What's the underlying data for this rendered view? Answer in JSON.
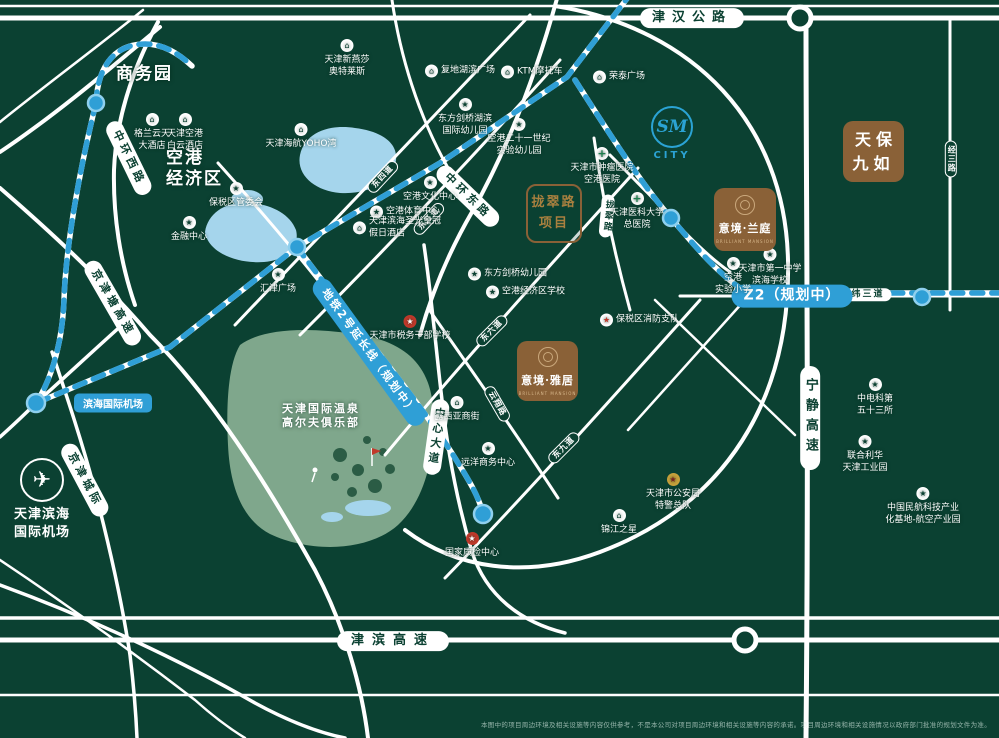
{
  "colors": {
    "background": "#0b4132",
    "road": "#ffffff",
    "metro_blue": "#2f9fd6",
    "lake": "#a5d5ec",
    "golf": "#7fa78c",
    "project_brown": "#8a6137"
  },
  "icon_glyphs": {
    "building": "⌂",
    "star": "★",
    "school": "★",
    "cross": "+",
    "red-star": "★",
    "police": "★",
    "fire": "★",
    "plane": "✈"
  },
  "map": {
    "area_labels": [
      {
        "id": "shangwuyuan",
        "text": "商务园",
        "x": 116,
        "y": 64,
        "size": 17
      },
      {
        "id": "konggang-jingjiqu",
        "text": "空港\n经济区",
        "x": 166,
        "y": 148,
        "size": 17
      },
      {
        "id": "golf-club",
        "text": "天津国际温泉\n高尔夫俱乐部",
        "x": 282,
        "y": 402,
        "size": 11
      }
    ],
    "project_boxes": [
      {
        "kind": "solid",
        "name": "天保九如",
        "lines": "天保\n九如",
        "x": 843,
        "y": 121,
        "w": 61,
        "h": 61
      },
      {
        "kind": "brand",
        "name": "意境·兰庭",
        "en": "BRILLIANT MANSION",
        "x": 714,
        "y": 188,
        "w": 62,
        "h": 63
      },
      {
        "kind": "brand",
        "name": "意境·雅居",
        "en": "BRILLIANT MANSION",
        "x": 517,
        "y": 341,
        "w": 61,
        "h": 60
      },
      {
        "kind": "outline",
        "name": "拢翠路项目",
        "lines": "拢翠路\n项目",
        "x": 526,
        "y": 184,
        "w": 52,
        "h": 55
      }
    ],
    "road_pills": [
      {
        "t": "津汉公路",
        "x": 692,
        "y": 18,
        "rot": 0,
        "style": "white",
        "size": 13,
        "ls": 7,
        "pad": "3px 12px"
      },
      {
        "t": "中环西路",
        "x": 129,
        "y": 158,
        "rot": 64,
        "style": "white",
        "size": 11,
        "ls": 4,
        "pad": "3px 10px"
      },
      {
        "t": "中环东路",
        "x": 468,
        "y": 196,
        "rot": 44,
        "style": "white",
        "size": 11,
        "ls": 4,
        "pad": "3px 10px"
      },
      {
        "t": "京津塘高速",
        "x": 113,
        "y": 303,
        "rot": 60,
        "style": "white",
        "size": 11,
        "ls": 4,
        "pad": "3px 10px"
      },
      {
        "t": "京津城际",
        "x": 85,
        "y": 480,
        "rot": 62,
        "style": "white",
        "size": 11,
        "ls": 4,
        "pad": "3px 10px"
      },
      {
        "t": "津滨高速",
        "x": 393,
        "y": 641,
        "rot": 0,
        "style": "white",
        "size": 13,
        "ls": 8,
        "pad": "3px 14px"
      },
      {
        "t": "宁静高速",
        "x": 810,
        "y": 418,
        "rot": 0,
        "style": "white",
        "size": 13,
        "ls": 7,
        "pad": "12px 3px",
        "vert": true
      },
      {
        "t": "中心大道",
        "x": 436,
        "y": 437,
        "rot": 8,
        "style": "white",
        "size": 11,
        "ls": 4,
        "pad": "8px 3px",
        "vert": true
      },
      {
        "t": "拢翠路",
        "x": 607,
        "y": 216,
        "rot": 5,
        "style": "white",
        "size": 9,
        "ls": 2,
        "pad": "5px 2px",
        "vert": true
      },
      {
        "t": "纬三道",
        "x": 868,
        "y": 295,
        "rot": 0,
        "style": "white",
        "size": 9,
        "ls": 2,
        "pad": "2px 7px"
      },
      {
        "t": "经三路",
        "x": 951,
        "y": 159,
        "rot": 0,
        "style": "green",
        "size": 8,
        "ls": 1,
        "pad": "4px 1px",
        "vert": true
      },
      {
        "t": "东四道",
        "x": 383,
        "y": 177,
        "rot": -47,
        "style": "green",
        "size": 8,
        "ls": 1,
        "pad": "1px 5px"
      },
      {
        "t": "东五道",
        "x": 429,
        "y": 219,
        "rot": -47,
        "style": "green",
        "size": 8,
        "ls": 1,
        "pad": "1px 5px"
      },
      {
        "t": "东六道",
        "x": 492,
        "y": 331,
        "rot": -45,
        "style": "green",
        "size": 8,
        "ls": 1,
        "pad": "1px 5px"
      },
      {
        "t": "东九道",
        "x": 564,
        "y": 448,
        "rot": -45,
        "style": "green",
        "size": 8,
        "ls": 1,
        "pad": "1px 5px"
      },
      {
        "t": "云翔路",
        "x": 497,
        "y": 404,
        "rot": 60,
        "style": "green",
        "size": 8,
        "ls": 1,
        "pad": "1px 5px"
      },
      {
        "t": "地铁2号延长线（规划中）",
        "x": 369,
        "y": 352,
        "rot": 54,
        "style": "blue",
        "size": 11,
        "ls": 2,
        "pad": "4px 12px"
      },
      {
        "t": "Z2（规划中）",
        "x": 792,
        "y": 296,
        "rot": 0,
        "style": "blue",
        "size": 14,
        "ls": 1,
        "pad": "4px 12px"
      }
    ],
    "station_tags": [
      {
        "t": "滨海国际机场",
        "x": 113,
        "y": 403,
        "size": 10
      }
    ],
    "pois": [
      {
        "t": "格兰云天\n大酒店",
        "x": 152,
        "y": 113,
        "icon": "building",
        "lp": "below"
      },
      {
        "t": "天津空港\n白云酒店",
        "x": 185,
        "y": 113,
        "icon": "building",
        "lp": "below"
      },
      {
        "t": "保税区管委会",
        "x": 236,
        "y": 182,
        "icon": "star",
        "lp": "below"
      },
      {
        "t": "金融中心",
        "x": 189,
        "y": 216,
        "icon": "star",
        "lp": "below"
      },
      {
        "t": "天津海航YOHO湾",
        "x": 301,
        "y": 123,
        "icon": "building",
        "lp": "below"
      },
      {
        "t": "天津新燕莎\n奥特莱斯",
        "x": 347,
        "y": 39,
        "icon": "building",
        "lp": "below"
      },
      {
        "t": "复地湖滨广场",
        "x": 432,
        "y": 71,
        "icon": "building",
        "lp": "right"
      },
      {
        "t": "KTM摩托车",
        "x": 508,
        "y": 72,
        "icon": "building",
        "lp": "right"
      },
      {
        "t": "东方剑桥湖滨\n国际幼儿园",
        "x": 465,
        "y": 98,
        "icon": "school",
        "lp": "below"
      },
      {
        "t": "空港二十一世纪\n实验幼儿园",
        "x": 519,
        "y": 118,
        "icon": "school",
        "lp": "below"
      },
      {
        "t": "荣泰广场",
        "x": 600,
        "y": 77,
        "icon": "building",
        "lp": "right"
      },
      {
        "t": "天津市肿瘤医院\n空港医院",
        "x": 602,
        "y": 147,
        "icon": "cross",
        "lp": "below"
      },
      {
        "t": "天津医科大学\n总医院",
        "x": 637,
        "y": 192,
        "icon": "cross",
        "lp": "below"
      },
      {
        "t": "东方剑桥幼儿园",
        "x": 475,
        "y": 274,
        "icon": "school",
        "lp": "right"
      },
      {
        "t": "空港经济区学校",
        "x": 493,
        "y": 292,
        "icon": "school",
        "lp": "right"
      },
      {
        "t": "空港文化中心",
        "x": 430,
        "y": 176,
        "icon": "star",
        "lp": "below"
      },
      {
        "t": "空港体育中心",
        "x": 377,
        "y": 212,
        "icon": "star",
        "lp": "right"
      },
      {
        "t": "天津滨海圣光皇冠\n假日酒店",
        "x": 360,
        "y": 228,
        "icon": "building",
        "lp": "right"
      },
      {
        "t": "汇津广场",
        "x": 278,
        "y": 268,
        "icon": "star",
        "lp": "below"
      },
      {
        "t": "天津市第一中学\n滨海学校",
        "x": 770,
        "y": 248,
        "icon": "school",
        "lp": "below"
      },
      {
        "t": "空港\n实验小学",
        "x": 733,
        "y": 257,
        "icon": "school",
        "lp": "below"
      },
      {
        "t": "保税区消防支队",
        "x": 607,
        "y": 320,
        "icon": "fire",
        "lp": "right"
      },
      {
        "t": "天津市税务干部学校",
        "x": 410,
        "y": 315,
        "icon": "red-star",
        "lp": "below"
      },
      {
        "t": "露西亚商街",
        "x": 457,
        "y": 396,
        "icon": "building",
        "lp": "below"
      },
      {
        "t": "远洋商务中心",
        "x": 488,
        "y": 442,
        "icon": "star",
        "lp": "below"
      },
      {
        "t": "天津市公安局\n特警总队",
        "x": 673,
        "y": 473,
        "icon": "police",
        "lp": "below"
      },
      {
        "t": "锦江之星",
        "x": 619,
        "y": 509,
        "icon": "building",
        "lp": "below"
      },
      {
        "t": "国家质检中心",
        "x": 472,
        "y": 532,
        "icon": "red-star",
        "lp": "below"
      },
      {
        "t": "中电科第\n五十三所",
        "x": 875,
        "y": 378,
        "icon": "star",
        "lp": "below"
      },
      {
        "t": "联合利华\n天津工业园",
        "x": 865,
        "y": 435,
        "icon": "star",
        "lp": "below"
      },
      {
        "t": "中国民航科技产业\n化基地-航空产业园",
        "x": 923,
        "y": 487,
        "icon": "star",
        "lp": "below"
      }
    ],
    "sm_city": {
      "top": "SM",
      "bottom": "CITY"
    },
    "airport_badge": {
      "name": "天津滨海\n国际机场"
    },
    "disclaimer": "本图中的项目周边环境及相关设施等内容仅供参考，不是本公司对项目周边环境和相关设施等内容的承诺。项目周边环境和相关设施情况以政府部门批准的规划文件为准。"
  }
}
